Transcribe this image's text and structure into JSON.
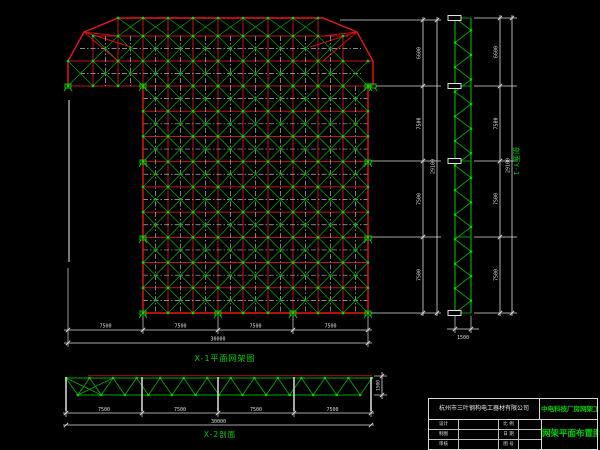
{
  "drawing": {
    "background": "#000000",
    "colors": {
      "red": "#c81414",
      "outline_red": "#f01414",
      "dark_red": "#8c0a0a",
      "green": "#00aa00",
      "node_green": "#00dc00",
      "dim": "#dcdcdc",
      "centerline": "#b4b4b4",
      "gray": "#787878",
      "text_green": "#00d200",
      "text_white": "#e8e8e8"
    },
    "plan": {
      "caption": "X-1平面网架图",
      "grid": {
        "cols": 9,
        "rows": 9
      },
      "bottom_dims": {
        "segments": [
          "7500",
          "7500",
          "7500",
          "7500"
        ],
        "total": "30000"
      },
      "right_dims": {
        "segments": [
          "6600",
          "7500",
          "7500",
          "7500"
        ],
        "total": "29100"
      }
    },
    "truss_y": {
      "label": "剖面Y-1",
      "panels": 12,
      "dims": {
        "segments": [
          "6600",
          "7500",
          "7500",
          "7500"
        ],
        "total": "29100",
        "width": "1500"
      }
    },
    "truss_x": {
      "caption": "X-2剖面",
      "panels": 13,
      "dims": {
        "segments": [
          "7500",
          "7500",
          "7500",
          "7500"
        ],
        "total": "30000",
        "height": "1500"
      }
    },
    "title_block": {
      "company": "杭州市三叶钢构电工器材有限公司",
      "project": "中电科技厂房网架工程",
      "drawing_title": "网架平面布置图",
      "rows": [
        {
          "label": "设计",
          "value": "",
          "f1": "比 例",
          "f2": ""
        },
        {
          "label": "制图",
          "value": "",
          "f1": "日 期",
          "f2": ""
        },
        {
          "label": "审核",
          "value": "",
          "f1": "图 号",
          "f2": ""
        }
      ]
    }
  }
}
